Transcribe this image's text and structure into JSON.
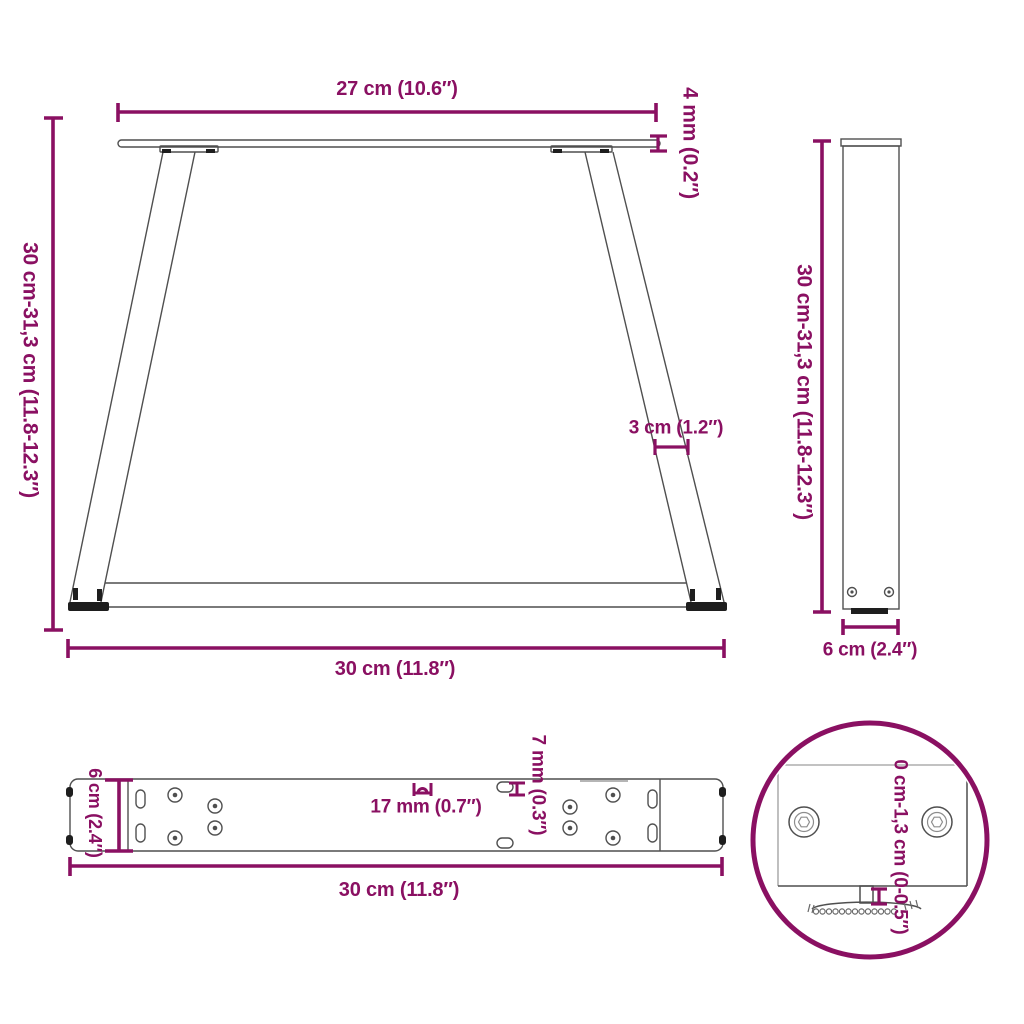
{
  "title": "Table leg dimensions technical diagram",
  "colors": {
    "dimension_accent": "#8A1062",
    "outline": "#4f4f4f",
    "dark_detail": "#1e1e1e"
  },
  "views": {
    "front": {
      "name": "front-view",
      "labels": {
        "top_width": "27 cm (10.6″)",
        "plate_thickness": "4 mm (0.2″)",
        "height_range": "30 cm-31,3 cm (11.8-12.3″)",
        "leg_width": "3 cm (1.2″)",
        "base_width": "30 cm (11.8″)"
      }
    },
    "side": {
      "name": "side-view",
      "labels": {
        "height_range": "30 cm-31,3 cm (11.8-12.3″)",
        "depth": "6 cm (2.4″)"
      }
    },
    "plate": {
      "name": "mounting-plate-top-view",
      "labels": {
        "depth": "6 cm (2.4″)",
        "slot_length": "17 mm (0.7″)",
        "slot_width": "7 mm (0.3″)",
        "length": "30 cm (11.8″)"
      }
    },
    "detail": {
      "name": "adjustable-foot-detail",
      "labels": {
        "height_adjustment": "0 cm-1,3 cm (0-0.5″)"
      }
    }
  }
}
